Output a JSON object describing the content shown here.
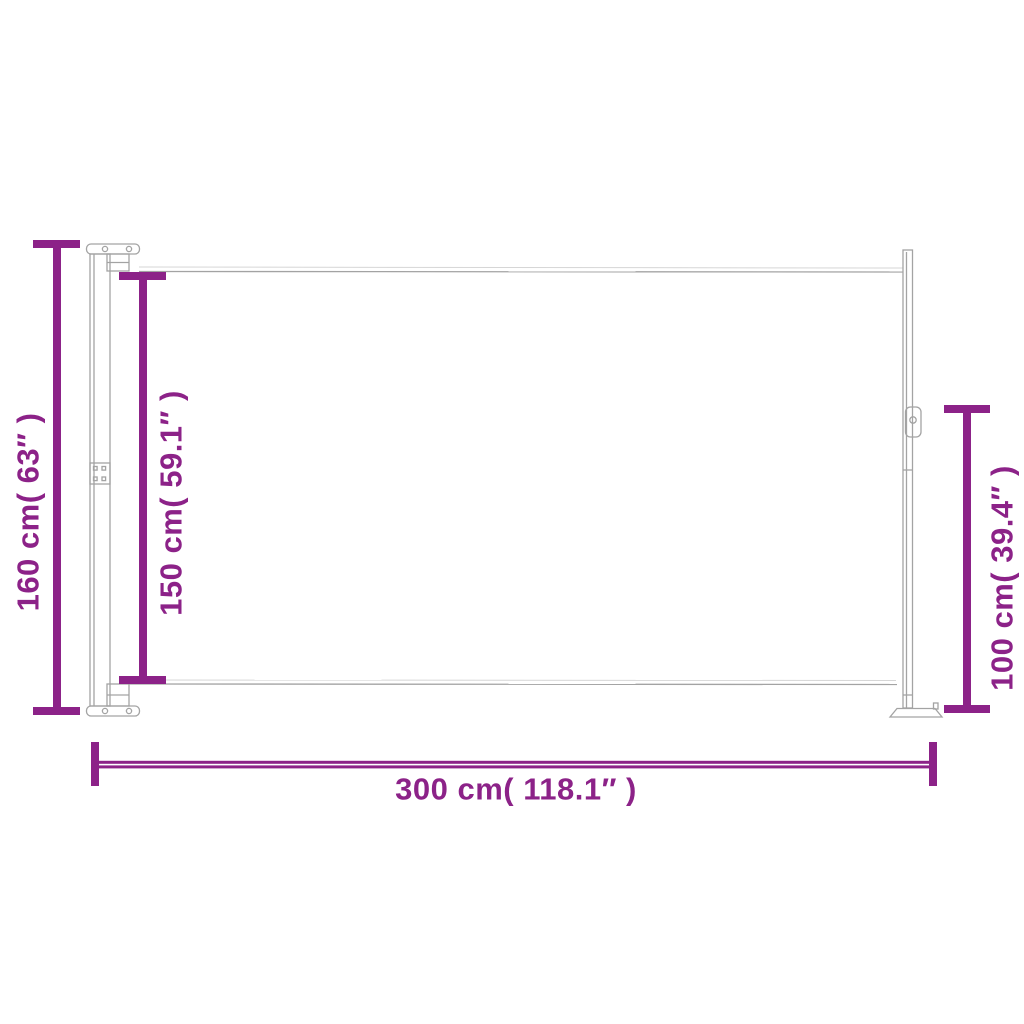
{
  "diagram": {
    "type": "product-dimension-diagram",
    "subject": "retractable-side-awning-side-view",
    "accent_color": "#8C2288",
    "line_color": "#A3A3A3",
    "background_color": "#FFFFFF",
    "dimensions": {
      "height_total": {
        "label": "160 cm( 63″ )",
        "value_cm": 160,
        "value_in": 63,
        "orientation": "vertical",
        "position": "far-left"
      },
      "height_fabric": {
        "label": "150 cm( 59.1″ )",
        "value_cm": 150,
        "value_in": 59.1,
        "orientation": "vertical",
        "position": "inner-left"
      },
      "height_post": {
        "label": "100 cm( 39.4″ )",
        "value_cm": 100,
        "value_in": 39.4,
        "orientation": "vertical",
        "position": "right"
      },
      "width_total": {
        "label": "300 cm( 118.1″ )",
        "value_cm": 300,
        "value_in": 118.1,
        "orientation": "horizontal",
        "position": "bottom"
      }
    }
  }
}
